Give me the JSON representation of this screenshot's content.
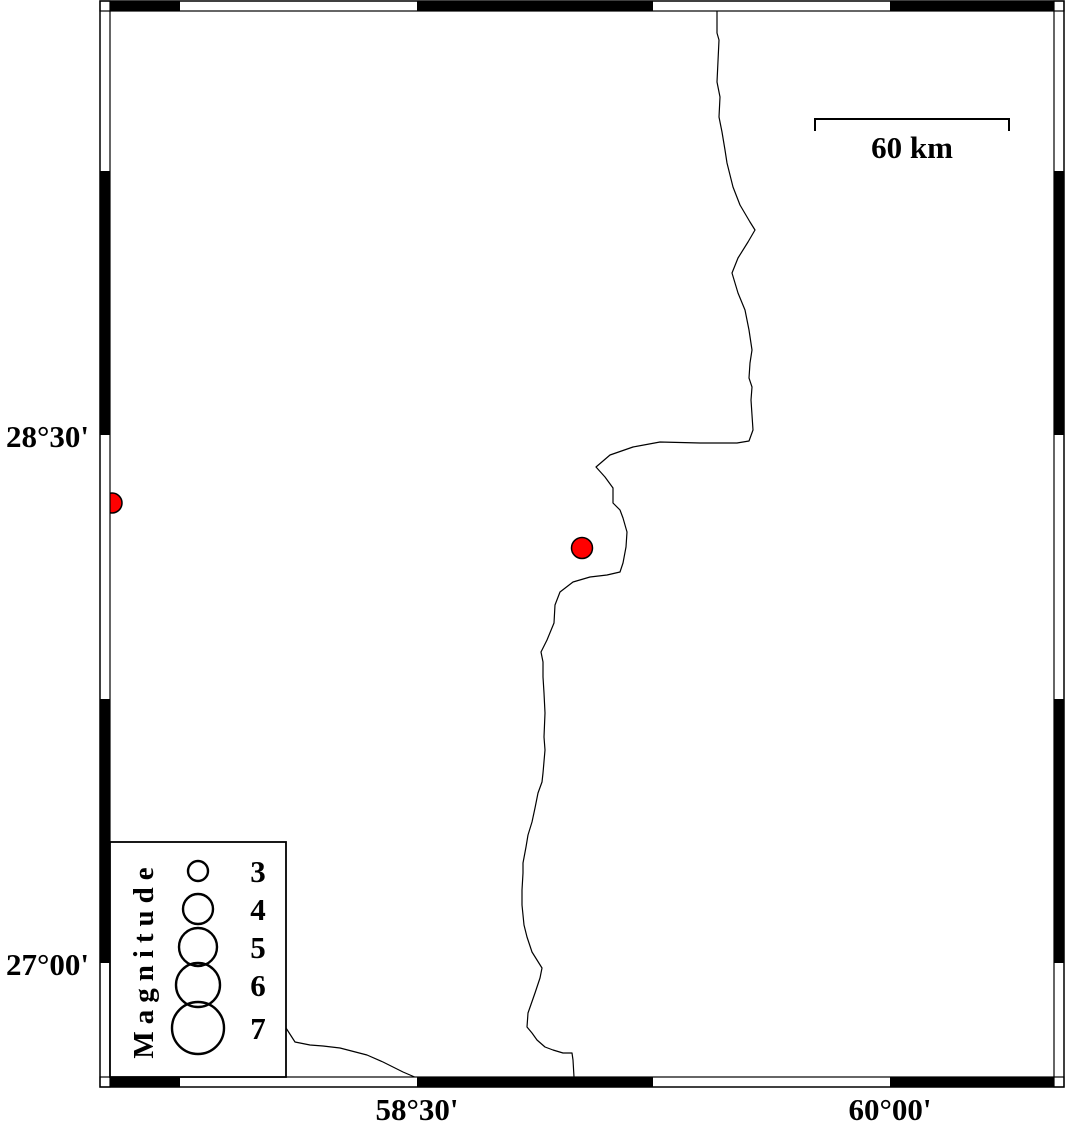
{
  "figure": {
    "width": 1066,
    "height": 1126,
    "background": "#ffffff"
  },
  "colors": {
    "line": "#000000",
    "frame_black": "#000000",
    "frame_white": "#ffffff",
    "earthquake_fill": "#ff0000"
  },
  "frame": {
    "inner": {
      "left": 110,
      "top": 11,
      "right": 1054,
      "bottom": 1077
    },
    "band": 10,
    "x_segment_boundaries": [
      180,
      417,
      653,
      890
    ],
    "y_segment_boundaries": [
      171,
      435,
      699,
      963
    ],
    "x_first_segment_black": true,
    "y_first_segment_black": false,
    "x_ticks": [
      {
        "label": "58°30'",
        "x": 417
      },
      {
        "label": "60°00'",
        "x": 890
      }
    ],
    "y_ticks": [
      {
        "label": "28°30'",
        "y": 435
      },
      {
        "label": "27°00'",
        "y": 963
      }
    ]
  },
  "scale_bar": {
    "label": "60 km",
    "x1": 815,
    "x2": 1009,
    "y": 119,
    "tick_drop": 12,
    "label_baseline_y": 158
  },
  "legend": {
    "title": "Magnitude",
    "box": {
      "x": 110,
      "y": 842,
      "w": 176,
      "h": 235
    },
    "title_cx": 143,
    "circle_cx": 198,
    "label_x": 258,
    "entries": [
      {
        "label": "3",
        "cy": 871,
        "r": 10
      },
      {
        "label": "4",
        "cy": 909,
        "r": 15
      },
      {
        "label": "5",
        "cy": 947,
        "r": 19
      },
      {
        "label": "6",
        "cy": 985,
        "r": 22
      },
      {
        "label": "7",
        "cy": 1028,
        "r": 26
      }
    ]
  },
  "earthquakes": [
    {
      "x": 582,
      "y": 548,
      "r": 10.5
    },
    {
      "x": 112,
      "y": 503,
      "r": 10
    }
  ],
  "coastlines": [
    [
      [
        717,
        11
      ],
      [
        717,
        33
      ],
      [
        719,
        40
      ],
      [
        717,
        82
      ],
      [
        720,
        97
      ],
      [
        719,
        117
      ],
      [
        722,
        132
      ],
      [
        725,
        150
      ],
      [
        727,
        163
      ],
      [
        733,
        187
      ],
      [
        740,
        205
      ],
      [
        750,
        222
      ],
      [
        755,
        230
      ],
      [
        748,
        242
      ],
      [
        738,
        258
      ],
      [
        732,
        273
      ],
      [
        738,
        293
      ],
      [
        745,
        310
      ],
      [
        749,
        330
      ],
      [
        752,
        350
      ],
      [
        750,
        363
      ],
      [
        749,
        378
      ],
      [
        752,
        387
      ],
      [
        751,
        400
      ],
      [
        753,
        430
      ],
      [
        749,
        441
      ],
      [
        737,
        443
      ],
      [
        700,
        443
      ],
      [
        660,
        442
      ],
      [
        633,
        447
      ],
      [
        610,
        455
      ],
      [
        596,
        467
      ],
      [
        605,
        477
      ],
      [
        613,
        488
      ],
      [
        613,
        503
      ],
      [
        620,
        510
      ],
      [
        623,
        518
      ],
      [
        627,
        532
      ],
      [
        626,
        547
      ],
      [
        623,
        563
      ],
      [
        620,
        572
      ],
      [
        607,
        575
      ],
      [
        590,
        577
      ],
      [
        573,
        582
      ],
      [
        560,
        592
      ],
      [
        555,
        605
      ],
      [
        554,
        623
      ],
      [
        547,
        640
      ],
      [
        541,
        652
      ],
      [
        543,
        662
      ],
      [
        543,
        677
      ],
      [
        544,
        693
      ],
      [
        545,
        713
      ],
      [
        544,
        737
      ],
      [
        545,
        750
      ],
      [
        543,
        773
      ],
      [
        542,
        782
      ],
      [
        538,
        793
      ],
      [
        535,
        808
      ],
      [
        532,
        822
      ],
      [
        528,
        835
      ],
      [
        526,
        847
      ],
      [
        523,
        863
      ],
      [
        523,
        873
      ],
      [
        522,
        890
      ],
      [
        522,
        905
      ],
      [
        524,
        925
      ],
      [
        527,
        937
      ],
      [
        532,
        952
      ],
      [
        542,
        968
      ],
      [
        540,
        978
      ],
      [
        535,
        993
      ],
      [
        528,
        1013
      ],
      [
        527,
        1027
      ],
      [
        532,
        1033
      ],
      [
        537,
        1040
      ],
      [
        545,
        1047
      ],
      [
        553,
        1050
      ],
      [
        563,
        1053
      ],
      [
        572,
        1053
      ],
      [
        573,
        1060
      ],
      [
        574,
        1077
      ]
    ],
    [
      [
        286,
        1028
      ],
      [
        295,
        1042
      ],
      [
        310,
        1045
      ],
      [
        323,
        1046
      ],
      [
        340,
        1048
      ],
      [
        367,
        1055
      ],
      [
        383,
        1062
      ],
      [
        403,
        1072
      ],
      [
        417,
        1078
      ]
    ]
  ]
}
